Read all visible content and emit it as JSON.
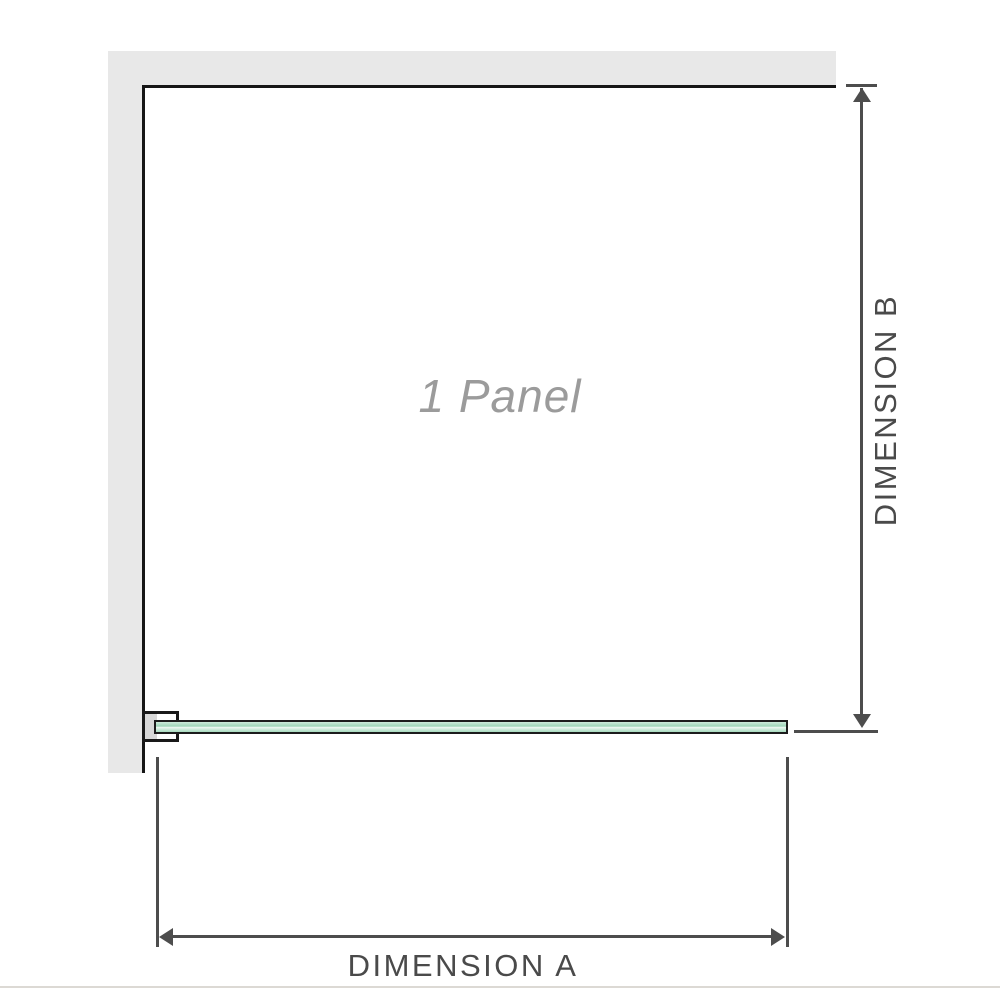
{
  "diagram": {
    "panel_label": "1 Panel",
    "dimension_a_label": "DIMENSION A",
    "dimension_b_label": "DIMENSION B"
  },
  "colors": {
    "wall_gray": "#e8e8e8",
    "panel_outline_black": "#161616",
    "dimension_gray": "#4d4d4d",
    "glass_green": "#9ed6b8",
    "glass_green_light": "#cdeadb",
    "panel_label_gray": "#9b9b9b",
    "bottom_divider": "#dcd9d4"
  }
}
